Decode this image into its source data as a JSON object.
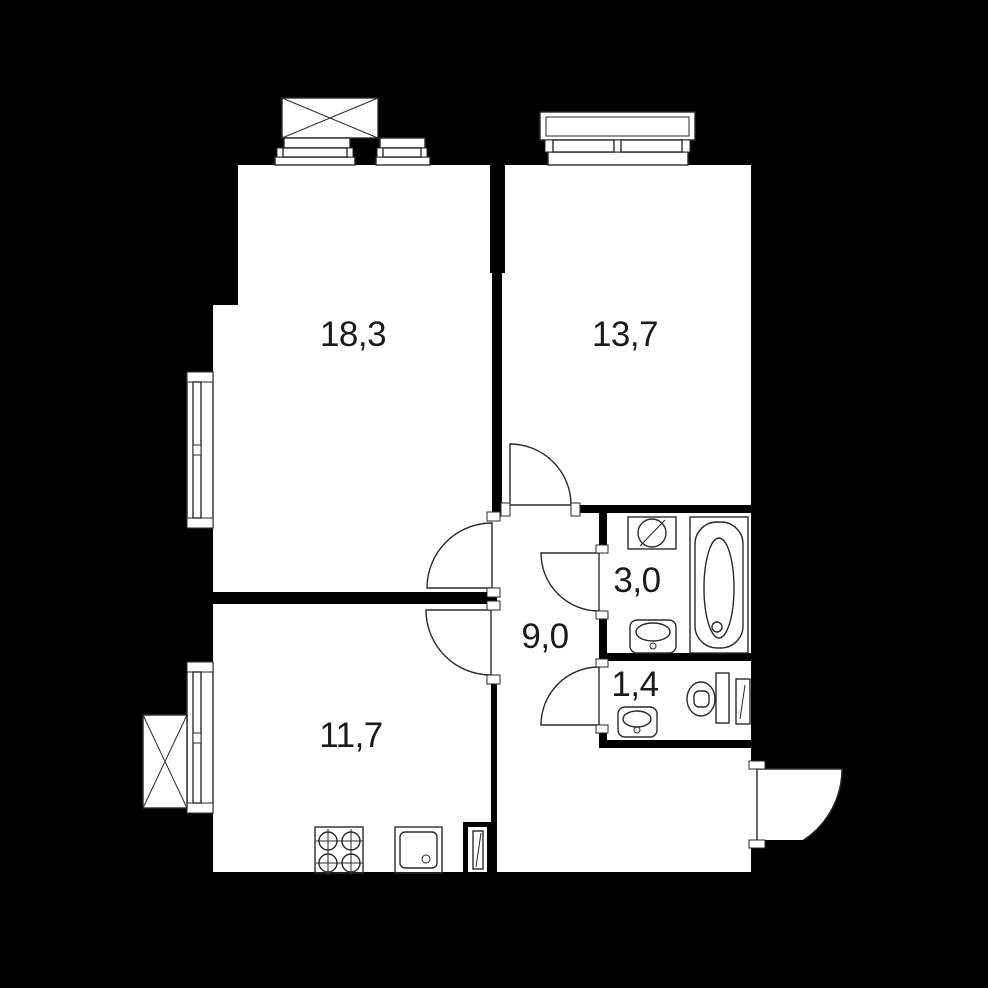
{
  "meta": {
    "type": "apartment-floor-plan",
    "background_color": "#000000",
    "floor_color": "#ffffff",
    "line_color": "#2a2a2a",
    "label_color": "#1a1a1a",
    "decimal_separator": ","
  },
  "rooms": {
    "living": {
      "name": "living-room",
      "area_label": "18,3"
    },
    "bedroom": {
      "name": "bedroom",
      "area_label": "13,7"
    },
    "bathroom": {
      "name": "bathroom",
      "area_label": "3,0"
    },
    "hallway": {
      "name": "hallway",
      "area_label": "9,0"
    },
    "wc": {
      "name": "wc",
      "area_label": "1,4"
    },
    "kitchen": {
      "name": "kitchen",
      "area_label": "11,7"
    }
  },
  "fixtures": [
    "window-living-top-large",
    "window-living-top-small",
    "window-living-left",
    "window-bedroom-top",
    "window-kitchen-left",
    "balcony-box-living",
    "balcony-box-kitchen",
    "washing-machine",
    "bathtub",
    "sink-bathroom",
    "sink-wc",
    "sink-kitchen",
    "toilet",
    "stove",
    "duct-shaft-kitchen",
    "duct-shaft-wc"
  ],
  "doors": [
    "door-living",
    "door-bedroom",
    "door-kitchen",
    "door-bathroom",
    "door-wc",
    "door-entrance"
  ]
}
